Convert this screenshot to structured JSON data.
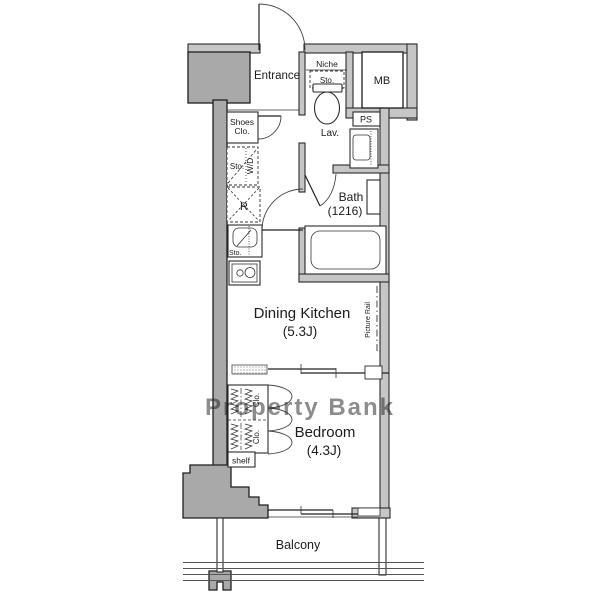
{
  "plan": {
    "watermark": "Property Bank",
    "colors": {
      "wall_fill": "#c6c6c6",
      "pillar_fill": "#a9a9a9",
      "line": "#2b2b2b",
      "watermark_text": "#bdbdbd"
    },
    "rooms": {
      "entrance": "Entrance",
      "lavatory": "Lav.",
      "bath": "Bath",
      "bath_size": "(1216)",
      "dining_kitchen": "Dining Kitchen",
      "dining_kitchen_size": "(5.3J)",
      "bedroom": "Bedroom",
      "bedroom_size": "(4.3J)",
      "balcony": "Balcony"
    },
    "labels": {
      "meter_box": "MB",
      "pipe_space": "PS",
      "niche": "Niche",
      "niche_storage": "Sto.",
      "shoes_closet_1": "Shoes",
      "shoes_closet_2": "Clo.",
      "storage": "Sto.",
      "washer_dryer": "W/D",
      "refrigerator": "R",
      "sink_storage": "Sto.",
      "picture_rail": "Picture Rail",
      "closet_upper": "Clo.",
      "closet_lower": "Clo.",
      "shelf": "shelf"
    }
  }
}
